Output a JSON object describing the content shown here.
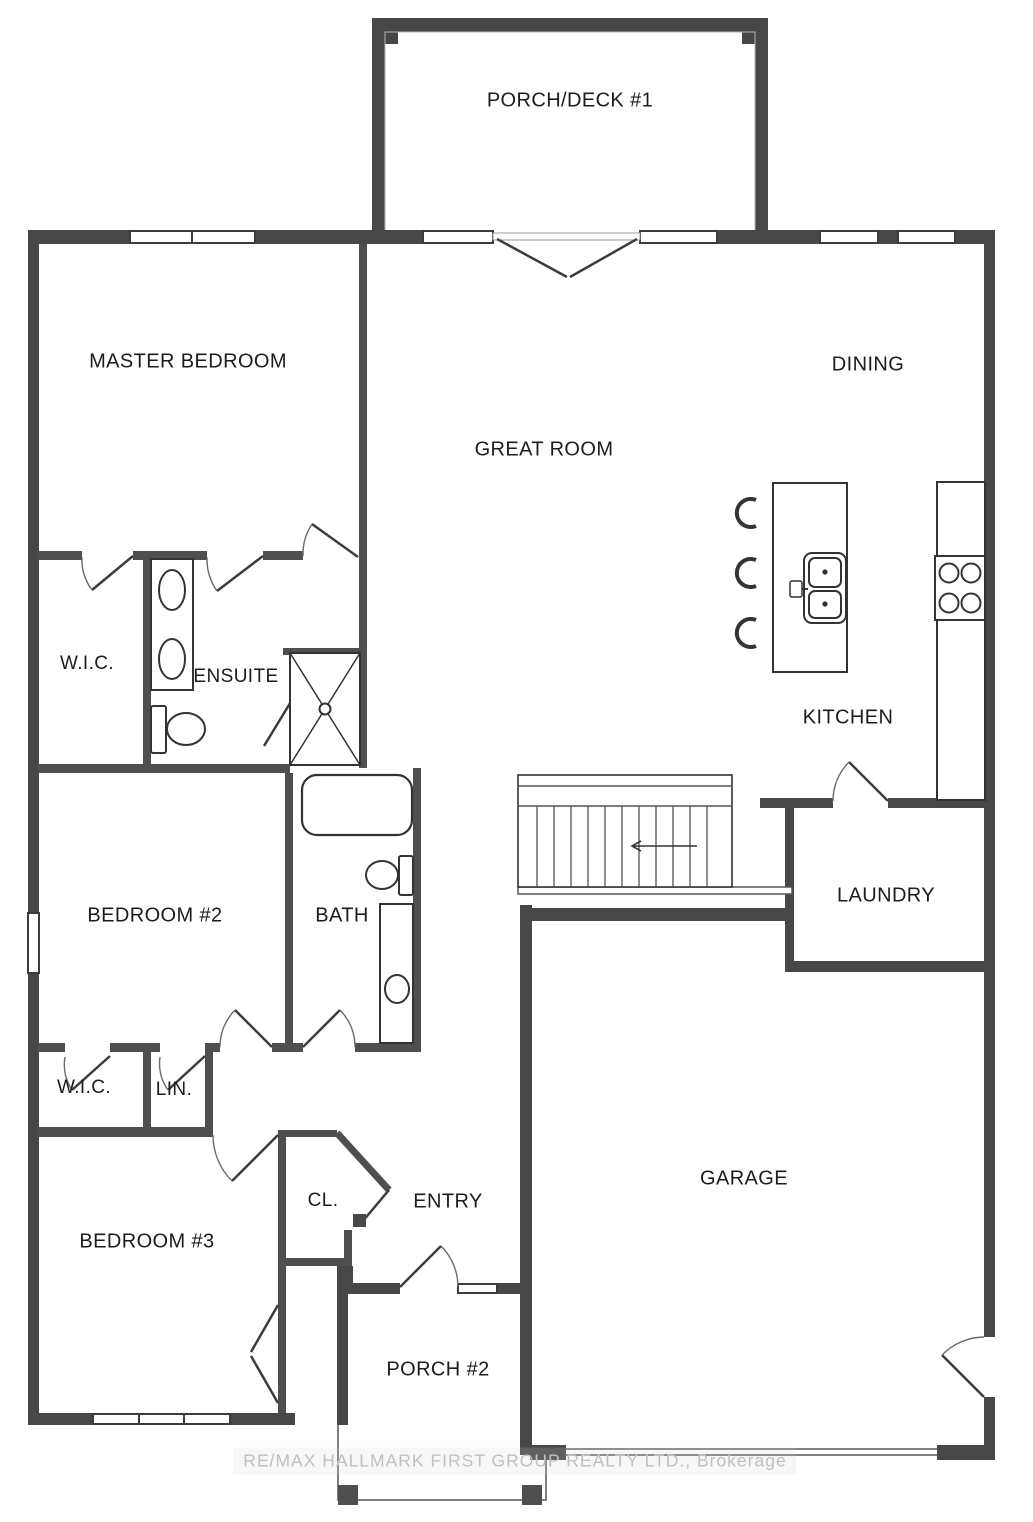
{
  "colors": {
    "wall_exterior": "#474747",
    "wall_interior": "#4f4f4f",
    "fixture_line": "#333333",
    "label_text": "#1c1c1c",
    "watermark_text": "#c0c0c0",
    "background": "#ffffff"
  },
  "rooms": {
    "porch_deck_1": {
      "label": "PORCH/DECK #1"
    },
    "master_bedroom": {
      "label": "MASTER BEDROOM"
    },
    "great_room": {
      "label": "GREAT ROOM"
    },
    "dining": {
      "label": "DINING"
    },
    "master_wic": {
      "label": "W.I.C."
    },
    "ensuite": {
      "label": "ENSUITE"
    },
    "kitchen": {
      "label": "KITCHEN"
    },
    "bedroom_2": {
      "label": "BEDROOM #2"
    },
    "bath": {
      "label": "BATH"
    },
    "laundry": {
      "label": "LAUNDRY"
    },
    "wic_2": {
      "label": "W.I.C."
    },
    "linen": {
      "label": "LIN."
    },
    "bedroom_3": {
      "label": "BEDROOM #3"
    },
    "closet": {
      "label": "CL."
    },
    "entry": {
      "label": "ENTRY"
    },
    "garage": {
      "label": "GARAGE"
    },
    "porch_2": {
      "label": "PORCH #2"
    }
  },
  "watermark": {
    "text": "RE/MAX HALLMARK FIRST GROUP REALTY LTD., Brokerage"
  }
}
